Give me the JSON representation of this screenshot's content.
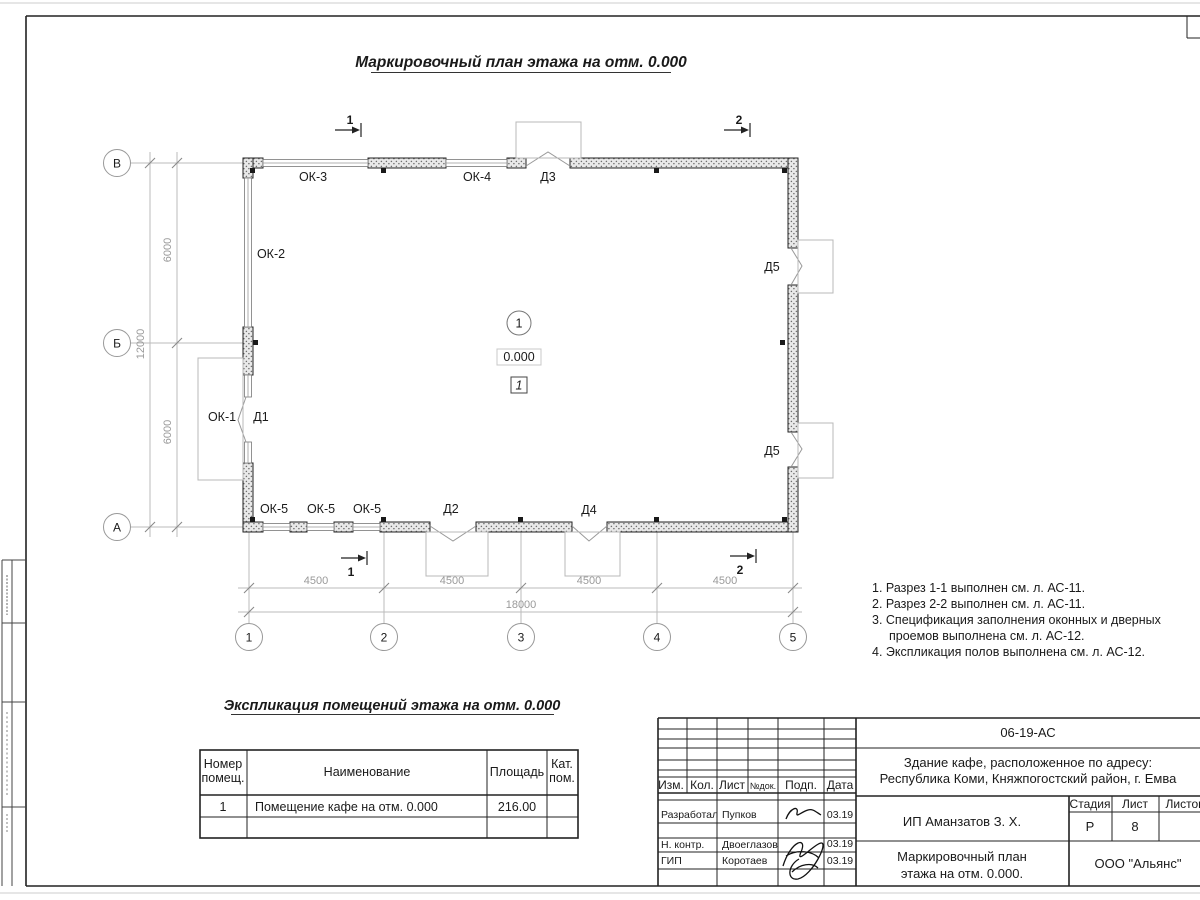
{
  "page": {
    "main_title": "Маркировочный план этажа на отм. 0.000"
  },
  "plan": {
    "row_axes": [
      "В",
      "Б",
      "А"
    ],
    "col_axes": [
      "1",
      "2",
      "3",
      "4",
      "5"
    ],
    "dims": {
      "v_segment": "6000",
      "v_total": "12000",
      "h_segment": "4500",
      "h_total": "18000"
    },
    "labels": {
      "ok1": "ОК-1",
      "ok2": "ОК-2",
      "ok3": "ОК-3",
      "ok4": "ОК-4",
      "ok5": "ОК-5",
      "d1": "Д1",
      "d2": "Д2",
      "d3": "Д3",
      "d4": "Д4",
      "d5": "Д5"
    },
    "markers": {
      "room_number": "1",
      "elevation": "0.000",
      "floor_type": "1"
    },
    "sections": {
      "s1": "1",
      "s2": "2"
    }
  },
  "notes": {
    "lines": [
      "1. Разрез 1-1 выполнен см. л. АС-11.",
      "2. Разрез 2-2 выполнен см. л. АС-11.",
      "3. Спецификация заполнения оконных и дверных",
      "проемов выполнена см. л. АС-12.",
      "4. Экспликация полов выполнена см. л. АС-12."
    ]
  },
  "room_table": {
    "title": "Экспликация помещений этажа на отм. 0.000",
    "headers": {
      "number_l1": "Номер",
      "number_l2": "помещ.",
      "name": "Наименование",
      "area": "Площадь",
      "cat_l1": "Кат.",
      "cat_l2": "пом."
    },
    "rows": [
      {
        "number": "1",
        "name": "Помещение кафе на отм. 0.000",
        "area": "216.00",
        "category": ""
      }
    ]
  },
  "title_block": {
    "doc_number": "06-19-АС",
    "object_line1": "Здание кафе, расположенное по адресу:",
    "object_line2": "Республика Коми, Княжпогостский район, г. Емва",
    "client": "ИП Аманзатов З. Х.",
    "sheet_name_line1": "Маркировочный план",
    "sheet_name_line2": "этажа на отм. 0.000.",
    "organization": "ООО \"Альянс\"",
    "stage_label": "Стадия",
    "stage_value": "Р",
    "sheet_label": "Лист",
    "sheet_value": "8",
    "sheets_label": "Листов",
    "columns": {
      "izm": "Изм.",
      "kol": "Кол.",
      "list": "Лист",
      "doc": "№док.",
      "podp": "Подп.",
      "date": "Дата"
    },
    "signers": [
      {
        "role": "Разработал",
        "name": "Пупков",
        "date": "03.19"
      },
      {
        "role": "Н. контр.",
        "name": "Двоеглазов",
        "date": "03.19"
      },
      {
        "role": "ГИП",
        "name": "Коротаев",
        "date": "03.19"
      }
    ]
  }
}
